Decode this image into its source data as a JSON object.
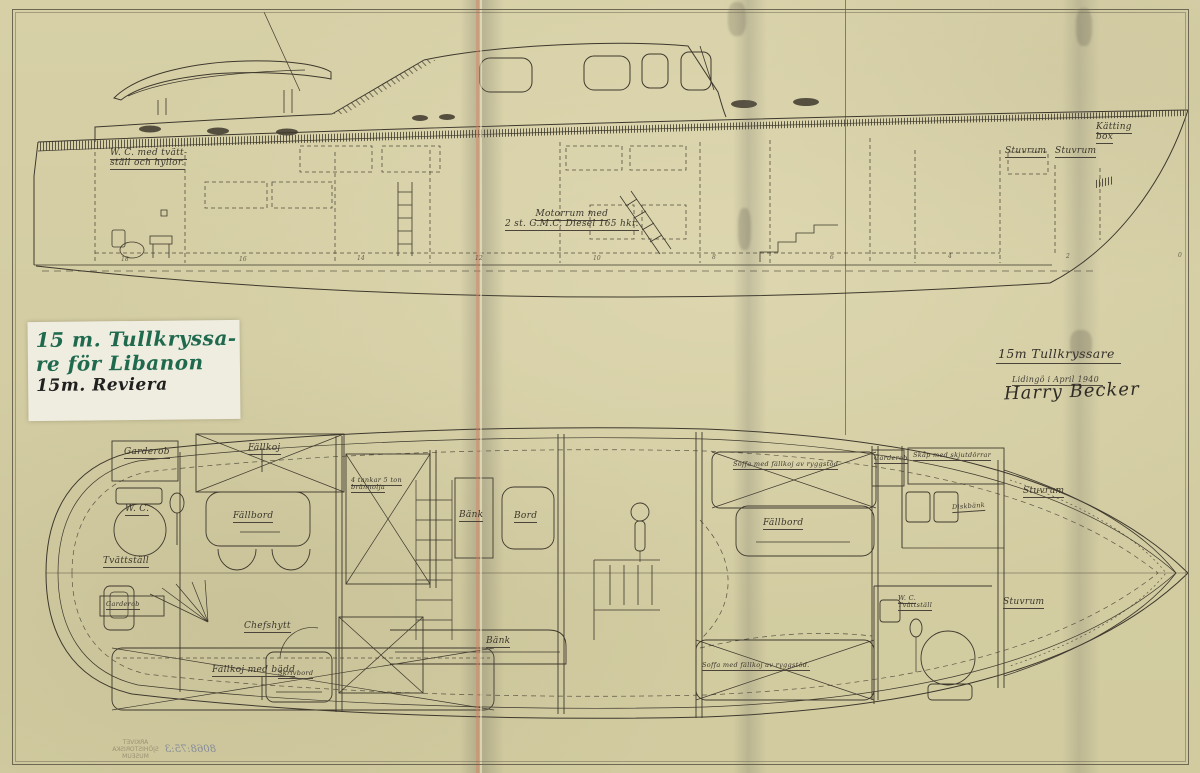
{
  "side": {
    "wc_line1": "W. C. med tvätt-",
    "wc_line2": "ställ och hyllor.",
    "motor_line1": "Motorrum med",
    "motor_line2": "2 st. G.M.C. Diesel 165 hkr.",
    "stuvrum_a": "Stuvrum",
    "stuvrum_b": "Stuvrum",
    "katting_line1": "Kätting",
    "katting_line2": "box",
    "stations": [
      "18",
      "16",
      "14",
      "12",
      "10",
      "8",
      "6",
      "4",
      "2",
      "0"
    ]
  },
  "plan": {
    "garderob_aft": "Garderob",
    "fallkoj": "Fällkoj",
    "wc": "W. C.",
    "fallbord_aft": "Fällbord",
    "tvattstall": "Tvättställ",
    "garderob_aft2": "Garderob",
    "chefshytt": "Chefshytt",
    "fallkoj_med_badd": "Fällkoj med bädd",
    "skrivbord": "Skrivbord",
    "tankar_line1": "4 tankar 5 ton",
    "tankar_line2": "brännolja",
    "bank_1": "Bänk",
    "bord": "Bord",
    "bank_2": "Bänk",
    "soffa_fwd": "Soffa med fällkoj av ryggstöd",
    "garderob_fwd": "Garderob",
    "skap": "Skåp med skjutdörrar",
    "diskbank": "Diskbänk",
    "fallbord_fwd": "Fällbord",
    "stuvrum_fwd": "Stuvrum",
    "wc_fwd_line1": "W. C.",
    "wc_fwd_line2": "Tvättställ",
    "stuvrum_aft2": "Stuvrum",
    "soffa_aft": "Soffa med fällkoj av ryggstöd."
  },
  "note": {
    "line1": "15 m. Tullkryssa-",
    "line2": "re för Libanon",
    "line3": "15m. Reviera"
  },
  "title_block": {
    "title": "15m Tullkryssare",
    "place_date": "Lidingö i April 1940",
    "signature": "Harry Becker"
  },
  "stamp": {
    "line1": "ARKIVET",
    "line2": "SJÖHISTORISKA",
    "line3": "MUSEUM",
    "number": "8068:75:3"
  }
}
